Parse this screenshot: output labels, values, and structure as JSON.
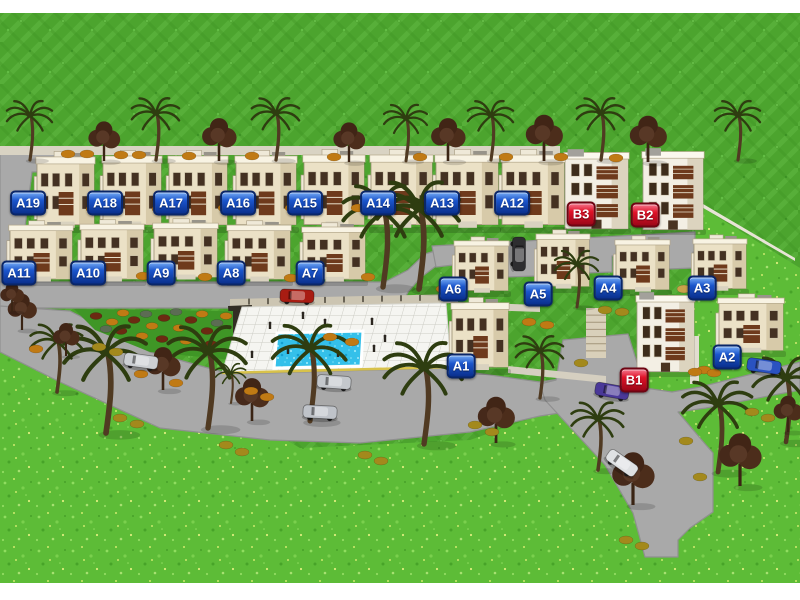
{
  "scene": {
    "description": "3D rendered residential compound site plan with labeled villas, pool and roads",
    "canvas": {
      "w": 800,
      "h": 600,
      "grass_top_y": 13,
      "grass_bottom_y": 583,
      "margin_color": "#ffffff"
    }
  },
  "colors": {
    "label_blue": "#1b55cc",
    "label_red": "#e01228",
    "road": "#a9a9a9",
    "road_edge": "#8f8f8f",
    "grass_striped": "#4ca42e",
    "grass_bright": "#5dbc37",
    "pool_water": "#34c0ea",
    "pool_deck": "#f5f5f1",
    "deck_edge_yellow": "#d8c24a",
    "building_wall": "#ebe1c6",
    "building_white": "#f3efe4",
    "balcony_brown": "#6e3a1c",
    "wall_light": "#d9d3c3"
  },
  "labels": [
    {
      "id": "A19",
      "x": 28,
      "y": 203,
      "s": "blue"
    },
    {
      "id": "A18",
      "x": 105,
      "y": 203,
      "s": "blue"
    },
    {
      "id": "A17",
      "x": 171,
      "y": 203,
      "s": "blue"
    },
    {
      "id": "A16",
      "x": 238,
      "y": 203,
      "s": "blue"
    },
    {
      "id": "A15",
      "x": 305,
      "y": 203,
      "s": "blue"
    },
    {
      "id": "A14",
      "x": 378,
      "y": 203,
      "s": "blue"
    },
    {
      "id": "A13",
      "x": 442,
      "y": 203,
      "s": "blue"
    },
    {
      "id": "A12",
      "x": 512,
      "y": 203,
      "s": "blue"
    },
    {
      "id": "B3",
      "x": 581,
      "y": 214,
      "s": "red"
    },
    {
      "id": "B2",
      "x": 645,
      "y": 215,
      "s": "red"
    },
    {
      "id": "A11",
      "x": 19,
      "y": 273,
      "s": "blue"
    },
    {
      "id": "A10",
      "x": 88,
      "y": 273,
      "s": "blue"
    },
    {
      "id": "A9",
      "x": 161,
      "y": 273,
      "s": "blue"
    },
    {
      "id": "A8",
      "x": 231,
      "y": 273,
      "s": "blue"
    },
    {
      "id": "A7",
      "x": 310,
      "y": 273,
      "s": "blue"
    },
    {
      "id": "A6",
      "x": 453,
      "y": 289,
      "s": "blue"
    },
    {
      "id": "A5",
      "x": 538,
      "y": 294,
      "s": "blue"
    },
    {
      "id": "A4",
      "x": 608,
      "y": 288,
      "s": "blue"
    },
    {
      "id": "A3",
      "x": 702,
      "y": 288,
      "s": "blue"
    },
    {
      "id": "A1",
      "x": 461,
      "y": 366,
      "s": "blue"
    },
    {
      "id": "B1",
      "x": 634,
      "y": 380,
      "s": "red"
    },
    {
      "id": "A2",
      "x": 727,
      "y": 357,
      "s": "blue"
    }
  ],
  "grass": {
    "top_rect": {
      "x": 0,
      "y": 13,
      "w": 800,
      "h": 340
    },
    "bright_points": "0,333 160,368 300,448 470,440 560,408 600,392 640,362 660,332 690,302 695,228 703,208 800,268 800,583 0,583"
  },
  "roads": [
    {
      "name": "perimeter-top-left",
      "points": "0,148 93,152 93,170 32,172 16,298 0,298"
    },
    {
      "name": "row2-road",
      "points": "0,282 385,282 408,270 425,254 448,247 462,246 462,262 436,266 420,278 408,292 400,308 0,308"
    },
    {
      "name": "cluster-road",
      "points": "432,246 695,232 695,252 693,252 693,268 668,269 668,253 612,256 612,272 585,273 585,257 536,260 536,276 506,277 506,261 462,264 436,267"
    },
    {
      "name": "main-sweep",
      "points": "0,306 70,311 150,352 230,374 448,368 468,372 540,382 566,378 566,412 540,416 470,432 360,443 270,440 160,428 60,382 0,352"
    },
    {
      "name": "south-exit-road",
      "points": "563,340 628,334 645,388 672,392 700,387 800,362 800,390 706,408 678,412 700,438 713,453 713,512 690,528 678,540 678,557 645,557 633,513 605,465 568,425 545,400 540,384 556,380"
    }
  ],
  "walls": [
    {
      "name": "north-boundary-wall",
      "points": "0,146 560,146 560,155 0,155",
      "fill": "#d9d3c3"
    },
    {
      "name": "east-boundary-fence",
      "points": "698,201 795,258 795,261 698,205",
      "fill": "#e8e4d6"
    },
    {
      "name": "pool-back-wall",
      "points": "230,299 458,294 458,303 230,308",
      "fill": "#ccc5b2",
      "posts": 11
    },
    {
      "name": "pool-corner-structure",
      "points": "228,306 252,305 246,344 230,340",
      "fill": "#332e24"
    },
    {
      "name": "stair-feature",
      "points": "586,308 606,308 606,358 586,358",
      "fill": "#d9d0ba",
      "stairs": 6
    },
    {
      "name": "wall-a1-b1",
      "points": "508,366 606,376 606,383 508,373",
      "fill": "#d5cfc0"
    },
    {
      "name": "wall-a2",
      "points": "690,336 699,336 699,384 690,384",
      "fill": "#e2ddd0"
    },
    {
      "name": "wall-a6-front",
      "points": "455,302 540,305 540,312 455,309",
      "fill": "#d5cfc0"
    }
  ],
  "garden": {
    "points": "74,309 233,311 233,360 150,352 95,330",
    "fill": "#3f9626",
    "bushes": [
      [
        96,
        316,
        "m"
      ],
      [
        112,
        322,
        "o"
      ],
      [
        123,
        313,
        "o"
      ],
      [
        134,
        320,
        "m"
      ],
      [
        146,
        314,
        "s"
      ],
      [
        152,
        326,
        "o"
      ],
      [
        164,
        318,
        "m"
      ],
      [
        176,
        312,
        "s"
      ],
      [
        179,
        328,
        "o"
      ],
      [
        191,
        320,
        "m"
      ],
      [
        202,
        314,
        "o"
      ],
      [
        207,
        331,
        "m"
      ],
      [
        217,
        323,
        "s"
      ],
      [
        226,
        316,
        "o"
      ],
      [
        142,
        336,
        "o"
      ],
      [
        162,
        339,
        "m"
      ],
      [
        186,
        341,
        "o"
      ],
      [
        211,
        344,
        "m"
      ],
      [
        121,
        331,
        "m"
      ],
      [
        106,
        329,
        "s"
      ]
    ]
  },
  "pool": {
    "deck_points": "242,307 446,303 451,367 222,373",
    "water_points": "277,333 363,331 361,366 274,368",
    "edge_line": {
      "x1": 222,
      "y1": 373,
      "x2": 451,
      "y2": 367
    }
  },
  "people": [
    [
      252,
      357
    ],
    [
      270,
      328
    ],
    [
      288,
      353
    ],
    [
      303,
      318
    ],
    [
      325,
      325
    ],
    [
      338,
      356
    ],
    [
      372,
      324
    ],
    [
      374,
      351
    ],
    [
      385,
      341
    ]
  ],
  "buildings": [
    {
      "id": "A19",
      "x": 37,
      "y": 153,
      "w": 57,
      "h": 78,
      "t": "v"
    },
    {
      "id": "A18",
      "x": 103,
      "y": 152,
      "w": 58,
      "h": 79,
      "t": "v"
    },
    {
      "id": "A17",
      "x": 169,
      "y": 152,
      "w": 58,
      "h": 79,
      "t": "v"
    },
    {
      "id": "A16",
      "x": 236,
      "y": 152,
      "w": 60,
      "h": 79,
      "t": "v"
    },
    {
      "id": "A15",
      "x": 304,
      "y": 151,
      "w": 60,
      "h": 80,
      "t": "v"
    },
    {
      "id": "A14",
      "x": 371,
      "y": 151,
      "w": 61,
      "h": 80,
      "t": "v"
    },
    {
      "id": "A13",
      "x": 436,
      "y": 151,
      "w": 62,
      "h": 80,
      "t": "v"
    },
    {
      "id": "A12",
      "x": 502,
      "y": 151,
      "w": 62,
      "h": 80,
      "t": "v"
    },
    {
      "id": "B3",
      "x": 565,
      "y": 150,
      "w": 63,
      "h": 82,
      "t": "b"
    },
    {
      "id": "B2",
      "x": 643,
      "y": 149,
      "w": 60,
      "h": 84,
      "t": "b"
    },
    {
      "id": "A11",
      "x": 10,
      "y": 222,
      "w": 62,
      "h": 62,
      "t": "v"
    },
    {
      "id": "A10",
      "x": 81,
      "y": 221,
      "w": 62,
      "h": 63,
      "t": "v"
    },
    {
      "id": "A9",
      "x": 154,
      "y": 220,
      "w": 63,
      "h": 62,
      "t": "v"
    },
    {
      "id": "A8",
      "x": 228,
      "y": 222,
      "w": 62,
      "h": 62,
      "t": "v"
    },
    {
      "id": "A7",
      "x": 303,
      "y": 224,
      "w": 62,
      "h": 60,
      "t": "v"
    },
    {
      "id": "A6",
      "x": 455,
      "y": 238,
      "w": 53,
      "h": 57,
      "t": "v"
    },
    {
      "id": "A5",
      "x": 537,
      "y": 231,
      "w": 52,
      "h": 60,
      "t": "v"
    },
    {
      "id": "A4",
      "x": 616,
      "y": 237,
      "w": 53,
      "h": 57,
      "t": "v"
    },
    {
      "id": "A3",
      "x": 694,
      "y": 236,
      "w": 52,
      "h": 57,
      "t": "v"
    },
    {
      "id": "A1",
      "x": 452,
      "y": 299,
      "w": 56,
      "h": 74,
      "t": "v"
    },
    {
      "id": "B1",
      "x": 637,
      "y": 293,
      "w": 57,
      "h": 82,
      "t": "b"
    },
    {
      "id": "A2",
      "x": 719,
      "y": 295,
      "w": 64,
      "h": 60,
      "t": "v"
    }
  ],
  "trees": {
    "palms": [
      [
        30,
        160,
        1.05
      ],
      [
        156,
        160,
        1.1
      ],
      [
        276,
        160,
        1.1
      ],
      [
        406,
        161,
        1.0
      ],
      [
        491,
        160,
        1.05
      ],
      [
        601,
        160,
        1.1
      ],
      [
        738,
        160,
        1.05
      ],
      [
        383,
        287,
        1.8
      ],
      [
        419,
        289,
        1.9
      ],
      [
        577,
        307,
        1.0
      ],
      [
        57,
        392,
        1.2
      ],
      [
        106,
        433,
        1.9
      ],
      [
        208,
        428,
        1.8
      ],
      [
        231,
        403,
        0.7
      ],
      [
        310,
        421,
        1.7
      ],
      [
        424,
        444,
        1.8
      ],
      [
        540,
        398,
        1.1
      ],
      [
        598,
        470,
        1.2
      ],
      [
        718,
        472,
        1.6
      ],
      [
        786,
        442,
        1.5
      ]
    ],
    "broadleaf": [
      [
        104,
        161,
        1.2
      ],
      [
        219,
        161,
        1.3
      ],
      [
        349,
        162,
        1.2
      ],
      [
        448,
        161,
        1.3
      ],
      [
        544,
        161,
        1.4
      ],
      [
        648,
        162,
        1.4
      ],
      [
        22,
        330,
        1.1
      ],
      [
        66,
        356,
        1.0
      ],
      [
        163,
        390,
        1.3
      ],
      [
        252,
        421,
        1.3
      ],
      [
        496,
        443,
        1.4
      ],
      [
        633,
        505,
        1.6
      ],
      [
        740,
        486,
        1.6
      ],
      [
        788,
        432,
        1.1
      ],
      [
        12,
        312,
        0.9
      ]
    ],
    "bushes": [
      [
        68,
        154,
        "o"
      ],
      [
        87,
        154,
        "o"
      ],
      [
        121,
        155,
        "o"
      ],
      [
        139,
        155,
        "o"
      ],
      [
        189,
        156,
        "o"
      ],
      [
        252,
        156,
        "o"
      ],
      [
        334,
        157,
        "o"
      ],
      [
        420,
        157,
        "o"
      ],
      [
        506,
        157,
        "o"
      ],
      [
        561,
        157,
        "o"
      ],
      [
        616,
        158,
        "o"
      ],
      [
        93,
        209,
        "o"
      ],
      [
        159,
        209,
        "o"
      ],
      [
        225,
        208,
        "o"
      ],
      [
        292,
        208,
        "o"
      ],
      [
        358,
        208,
        "o"
      ],
      [
        143,
        276,
        "o"
      ],
      [
        205,
        277,
        "o"
      ],
      [
        291,
        278,
        "o"
      ],
      [
        368,
        277,
        "o"
      ],
      [
        443,
        289,
        "o"
      ],
      [
        529,
        322,
        "o"
      ],
      [
        547,
        325,
        "o"
      ],
      [
        605,
        310,
        "y"
      ],
      [
        622,
        312,
        "y"
      ],
      [
        684,
        289,
        "t"
      ],
      [
        704,
        370,
        "o"
      ],
      [
        714,
        373,
        "o"
      ],
      [
        36,
        349,
        "o"
      ],
      [
        99,
        347,
        "y"
      ],
      [
        116,
        352,
        "y"
      ],
      [
        141,
        374,
        "o"
      ],
      [
        176,
        383,
        "o"
      ],
      [
        251,
        391,
        "o"
      ],
      [
        267,
        397,
        "o"
      ],
      [
        120,
        418,
        "y"
      ],
      [
        137,
        424,
        "y"
      ],
      [
        226,
        445,
        "y"
      ],
      [
        242,
        452,
        "y"
      ],
      [
        365,
        455,
        "y"
      ],
      [
        381,
        461,
        "y"
      ],
      [
        475,
        425,
        "y"
      ],
      [
        492,
        432,
        "y"
      ],
      [
        581,
        363,
        "y"
      ],
      [
        695,
        372,
        "o"
      ],
      [
        752,
        412,
        "y"
      ],
      [
        768,
        418,
        "y"
      ],
      [
        686,
        441,
        "y"
      ],
      [
        626,
        540,
        "y"
      ],
      [
        642,
        546,
        "y"
      ],
      [
        700,
        477,
        "y"
      ],
      [
        330,
        337,
        "o"
      ],
      [
        352,
        342,
        "o"
      ]
    ]
  },
  "cars": [
    {
      "name": "red-car",
      "x": 297,
      "y": 296,
      "a": 2,
      "c": "#a81c12"
    },
    {
      "name": "dark-car",
      "x": 519,
      "y": 254,
      "a": 90,
      "c": "#2e2e30"
    },
    {
      "name": "silver-car-1",
      "x": 141,
      "y": 361,
      "a": 8,
      "c": "#cdd0d4"
    },
    {
      "name": "silver-car-2",
      "x": 334,
      "y": 382,
      "a": 4,
      "c": "#c4c8cc"
    },
    {
      "name": "silver-car-3",
      "x": 320,
      "y": 412,
      "a": 3,
      "c": "#bfc3c9"
    },
    {
      "name": "white-car",
      "x": 622,
      "y": 463,
      "a": 35,
      "c": "#dfe1e3"
    },
    {
      "name": "purple-car",
      "x": 612,
      "y": 391,
      "a": 10,
      "c": "#4a3898"
    },
    {
      "name": "blue-car",
      "x": 764,
      "y": 366,
      "a": 8,
      "c": "#2a52c0"
    }
  ]
}
